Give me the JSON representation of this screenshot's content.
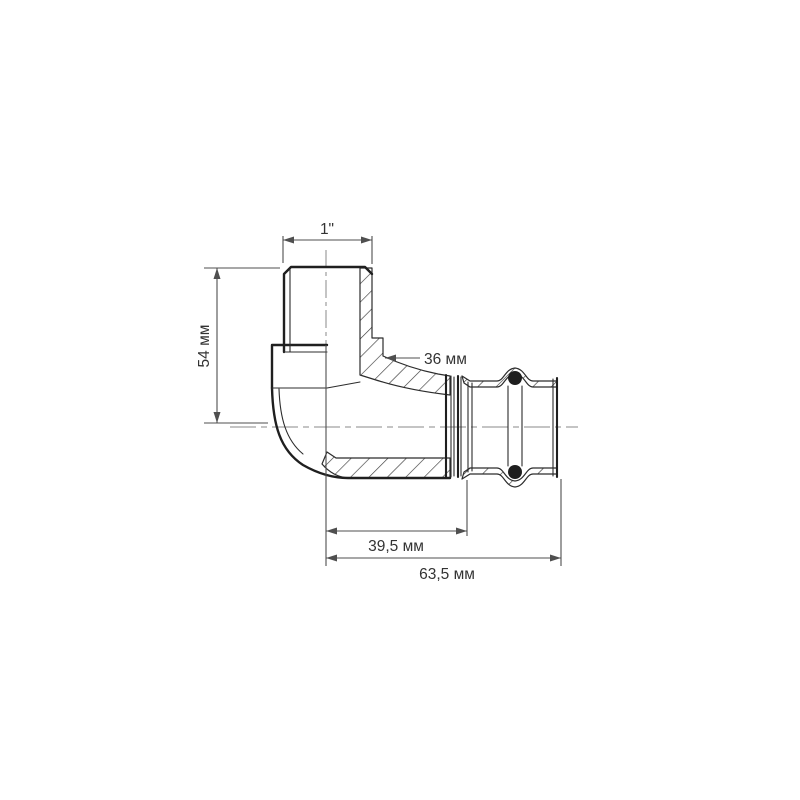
{
  "drawing": {
    "labels": {
      "thread_size": "1\"",
      "height": "54 мм",
      "body_width": "36 мм",
      "insertion_length": "39,5 мм",
      "overall_length": "63,5 мм"
    },
    "colors": {
      "background": "#ffffff",
      "outline": "#1f1f1f",
      "thin_line": "#2c2c2c",
      "hatch": "#3a3a3a",
      "dimension": "#4f4f4f",
      "centerline": "#8a8a8a",
      "text": "#333333",
      "oring": "#1e1e1e"
    }
  }
}
